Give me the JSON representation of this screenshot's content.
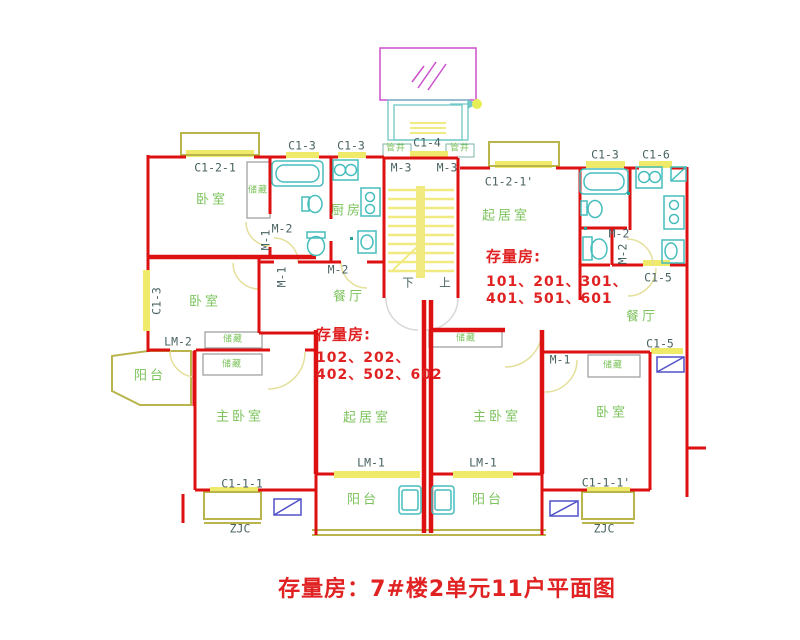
{
  "title": "存量房：7#楼2单元11户平面图",
  "colors": {
    "wall": "#dd1111",
    "window_sill": "#f0ea6a",
    "bay_outline": "#b9b44c",
    "room_text": "#7cc35c",
    "code_text": "#4a6362",
    "note_text": "#e02222",
    "fixture": "#46bdbd",
    "canopy": "#cc4fcc",
    "ac_unit": "#5050c8",
    "closet": "#9a9a9a"
  },
  "labels": [
    {
      "n": "room-label-bedroom-1",
      "t": "卧室",
      "x": 212,
      "y": 200,
      "c": "room"
    },
    {
      "n": "room-label-bedroom-2",
      "t": "卧室",
      "x": 205,
      "y": 302,
      "c": "room"
    },
    {
      "n": "room-label-bedroom-3",
      "t": "卧室",
      "x": 612,
      "y": 413,
      "c": "room"
    },
    {
      "n": "room-label-master-bedroom-left",
      "t": "主卧室",
      "x": 240,
      "y": 417,
      "c": "room"
    },
    {
      "n": "room-label-master-bedroom-right",
      "t": "主卧室",
      "x": 497,
      "y": 417,
      "c": "room"
    },
    {
      "n": "room-label-living-room-left",
      "t": "起居室",
      "x": 367,
      "y": 418,
      "c": "room"
    },
    {
      "n": "room-label-living-room-right",
      "t": "起居室",
      "x": 506,
      "y": 216,
      "c": "room"
    },
    {
      "n": "room-label-kitchen-left",
      "t": "厨房",
      "x": 347,
      "y": 211,
      "c": "room"
    },
    {
      "n": "room-label-dining-left",
      "t": "餐厅",
      "x": 349,
      "y": 297,
      "c": "room"
    },
    {
      "n": "room-label-dining-right",
      "t": "餐厅",
      "x": 642,
      "y": 317,
      "c": "room"
    },
    {
      "n": "room-label-balcony-sw",
      "t": "阳台",
      "x": 150,
      "y": 376,
      "c": "room"
    },
    {
      "n": "room-label-balcony-left",
      "t": "阳台",
      "x": 363,
      "y": 500,
      "c": "room"
    },
    {
      "n": "room-label-balcony-right",
      "t": "阳台",
      "x": 488,
      "y": 500,
      "c": "room"
    },
    {
      "n": "storage-label-1",
      "t": "储藏",
      "x": 258,
      "y": 191,
      "c": "storage"
    },
    {
      "n": "storage-label-2",
      "t": "储藏",
      "x": 233,
      "y": 340,
      "c": "storage"
    },
    {
      "n": "storage-label-3",
      "t": "储藏",
      "x": 232,
      "y": 365,
      "c": "storage"
    },
    {
      "n": "storage-label-4",
      "t": "储藏",
      "x": 466,
      "y": 339,
      "c": "storage"
    },
    {
      "n": "storage-label-5",
      "t": "储藏",
      "x": 613,
      "y": 366,
      "c": "storage"
    },
    {
      "n": "pipe-shaft-label-left",
      "t": "管井",
      "x": 396,
      "y": 149,
      "c": "storage"
    },
    {
      "n": "pipe-shaft-label-right",
      "t": "管井",
      "x": 460,
      "y": 149,
      "c": "storage"
    },
    {
      "n": "code-c1-2-1",
      "t": "C1-2-1",
      "x": 215,
      "y": 168,
      "c": "code"
    },
    {
      "n": "code-c1-3-bath-left",
      "t": "C1-3",
      "x": 302,
      "y": 146,
      "c": "code"
    },
    {
      "n": "code-c1-3-kitchen-left",
      "t": "C1-3",
      "x": 351,
      "y": 146,
      "c": "code"
    },
    {
      "n": "code-c1-4",
      "t": "C1-4",
      "x": 427,
      "y": 143,
      "c": "code"
    },
    {
      "n": "code-c1-3-bath-right",
      "t": "C1-3",
      "x": 605,
      "y": 155,
      "c": "code"
    },
    {
      "n": "code-c1-6",
      "t": "C1-6",
      "x": 656,
      "y": 155,
      "c": "code"
    },
    {
      "n": "code-c1-2-1p",
      "t": "C1-2-1'",
      "x": 509,
      "y": 182,
      "c": "code"
    },
    {
      "n": "code-m3-left",
      "t": "M-3",
      "x": 401,
      "y": 168,
      "c": "code"
    },
    {
      "n": "code-m3-right",
      "t": "M-3",
      "x": 447,
      "y": 168,
      "c": "code"
    },
    {
      "n": "code-m2-bath-left",
      "t": "M-2",
      "x": 282,
      "y": 229,
      "c": "code"
    },
    {
      "n": "code-m1-wc-left",
      "t": "M-1",
      "x": 266,
      "y": 240,
      "c": "code",
      "r": 1
    },
    {
      "n": "code-m1-hall-left",
      "t": "M-1",
      "x": 282,
      "y": 277,
      "c": "code",
      "r": 1
    },
    {
      "n": "code-m2-kitchen-left",
      "t": "M-2",
      "x": 338,
      "y": 270,
      "c": "code"
    },
    {
      "n": "code-m2-bath-right",
      "t": "M-2",
      "x": 619,
      "y": 234,
      "c": "code"
    },
    {
      "n": "code-m2-wc-right",
      "t": "M-2",
      "x": 623,
      "y": 254,
      "c": "code",
      "r": 1
    },
    {
      "n": "code-c1-5-kitchen",
      "t": "C1-5",
      "x": 658,
      "y": 278,
      "c": "code"
    },
    {
      "n": "code-c1-3-west",
      "t": "C1-3",
      "x": 157,
      "y": 301,
      "c": "code",
      "r": 1
    },
    {
      "n": "code-lm2",
      "t": "LM-2",
      "x": 178,
      "y": 342,
      "c": "code"
    },
    {
      "n": "code-m1-bedroom-right",
      "t": "M-1",
      "x": 560,
      "y": 360,
      "c": "code"
    },
    {
      "n": "code-c1-5-south",
      "t": "C1-5",
      "x": 660,
      "y": 344,
      "c": "code"
    },
    {
      "n": "code-lm1-left",
      "t": "LM-1",
      "x": 371,
      "y": 463,
      "c": "code"
    },
    {
      "n": "code-lm1-right",
      "t": "LM-1",
      "x": 483,
      "y": 463,
      "c": "code"
    },
    {
      "n": "code-c1-1-1",
      "t": "C1-1-1",
      "x": 242,
      "y": 484,
      "c": "code"
    },
    {
      "n": "code-c1-1-1p",
      "t": "C1-1-1'",
      "x": 606,
      "y": 483,
      "c": "code"
    },
    {
      "n": "code-zjc-left",
      "t": "ZJC",
      "x": 240,
      "y": 529,
      "c": "code"
    },
    {
      "n": "code-zjc-right",
      "t": "ZJC",
      "x": 604,
      "y": 529,
      "c": "code"
    },
    {
      "n": "stair-down-label",
      "t": "下",
      "x": 408,
      "y": 283,
      "c": "code"
    },
    {
      "n": "stair-up-label",
      "t": "上",
      "x": 445,
      "y": 283,
      "c": "code"
    },
    {
      "n": "note-right-header",
      "t": "存量房:",
      "x": 486,
      "y": 257,
      "c": "note-bold"
    },
    {
      "n": "note-right-line1",
      "t": "101、201、301、",
      "x": 486,
      "y": 282,
      "c": "note"
    },
    {
      "n": "note-right-line2",
      "t": "401、501、601",
      "x": 486,
      "y": 299,
      "c": "note"
    },
    {
      "n": "note-left-header",
      "t": "存量房:",
      "x": 316,
      "y": 335,
      "c": "note-bold"
    },
    {
      "n": "note-left-line1",
      "t": "102、202、",
      "x": 316,
      "y": 358,
      "c": "note"
    },
    {
      "n": "note-left-line2",
      "t": "402、502、602",
      "x": 316,
      "y": 375,
      "c": "note"
    }
  ]
}
